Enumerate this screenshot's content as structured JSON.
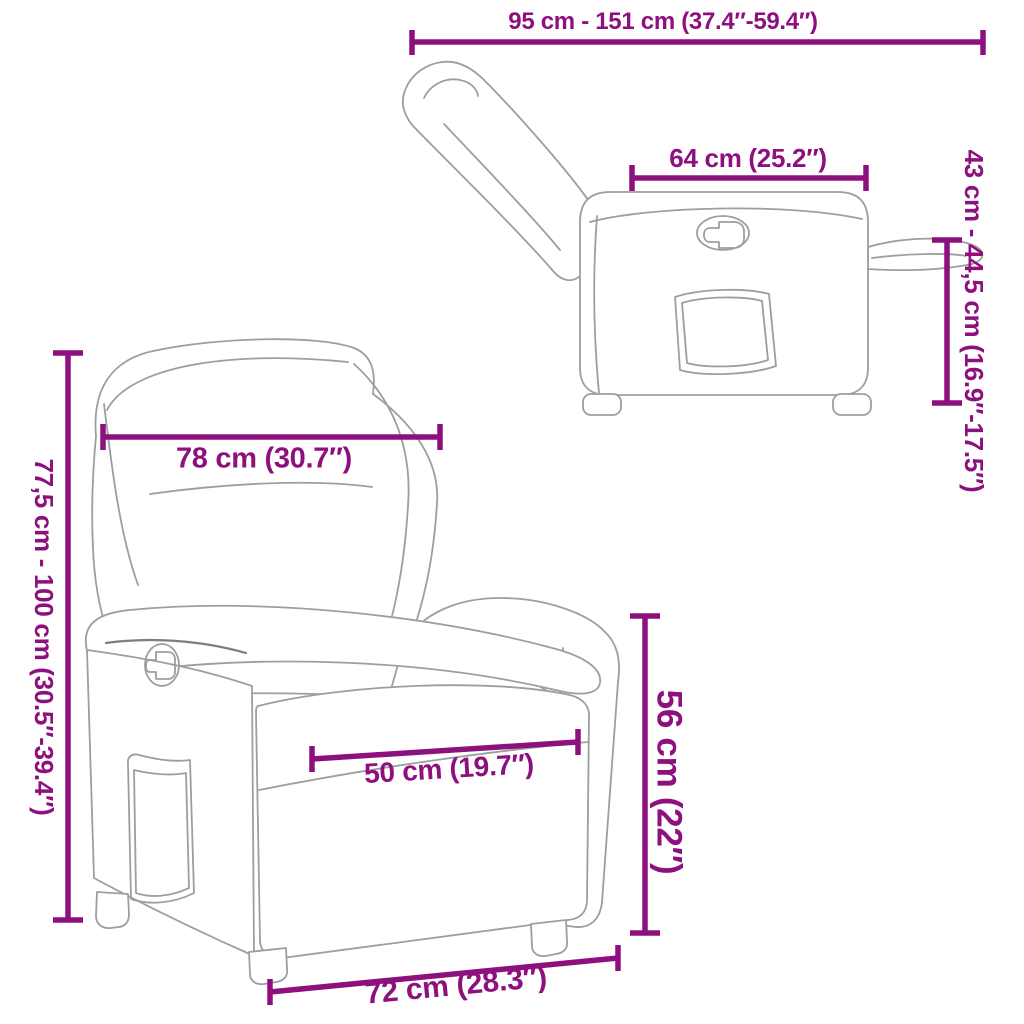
{
  "image": {
    "type": "product-dimension-diagram",
    "subject": "reclining armchair line drawing (reclined side view and upright front view)",
    "background_color": "#ffffff",
    "dimension_color": "#8E107E",
    "drawing_line_color": "#9e9e9e"
  },
  "dimensions": {
    "overall_depth": "95 cm - 151 cm (37.4″-59.4″)",
    "top_depth": "64 cm (25.2″)",
    "footrest_height": "43 cm - 44,5 cm (16.9″-17.5″)",
    "back_width": "78 cm (30.7″)",
    "overall_height": "77,5 cm - 100 cm (30.5″-39.4″)",
    "seat_width": "50 cm (19.7″)",
    "seat_height": "56 cm (22″)",
    "base_width": "72 cm (28.3″)"
  }
}
